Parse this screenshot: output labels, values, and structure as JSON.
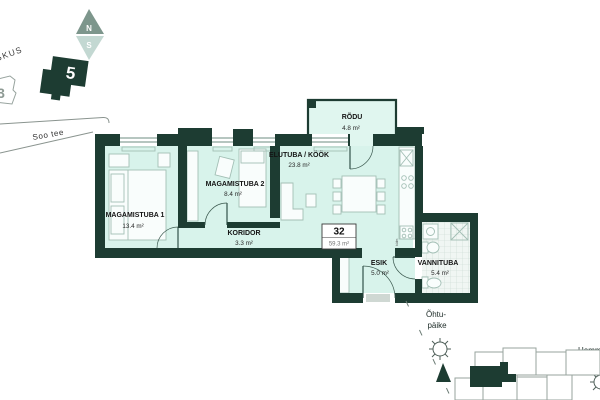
{
  "site": {
    "compass_north": "N",
    "compass_south": "S",
    "building_number": "5",
    "neighbor_building_number": "3",
    "district_label": "KESKUS",
    "street_name": "Soo tee",
    "evening_sun": {
      "line1": "Õhtu-",
      "line2": "päike"
    },
    "morning_sun": {
      "line1": "Hommiku-",
      "line2": "päike"
    }
  },
  "apartment": {
    "number": "32",
    "total_area": "59.3 m²",
    "rooms": {
      "magamistuba1": {
        "name": "MAGAMISTUBA 1",
        "area": "13.4 m²"
      },
      "magamistuba2": {
        "name": "MAGAMISTUBA 2",
        "area": "8.4 m²"
      },
      "koridor": {
        "name": "KORIDOR",
        "area": "3.3 m²"
      },
      "elutuba": {
        "name": "ELUTUBA / KÖÖK",
        "area": "23.8 m²"
      },
      "rodu": {
        "name": "RÕDU",
        "area": "4.8 m²"
      },
      "esik": {
        "name": "ESIK",
        "area": "5.0 m²"
      },
      "vannituba": {
        "name": "VANNITUBA",
        "area": "5.4 m²"
      }
    },
    "kitchen_fridge_label": "külm"
  },
  "colors": {
    "wall": "#1d3c32",
    "room_fill": "#d8f3eb",
    "balcony_fill": "#e0f6ef",
    "outline_gray": "#97a39e",
    "highlight_dark": "#1d3c32"
  }
}
